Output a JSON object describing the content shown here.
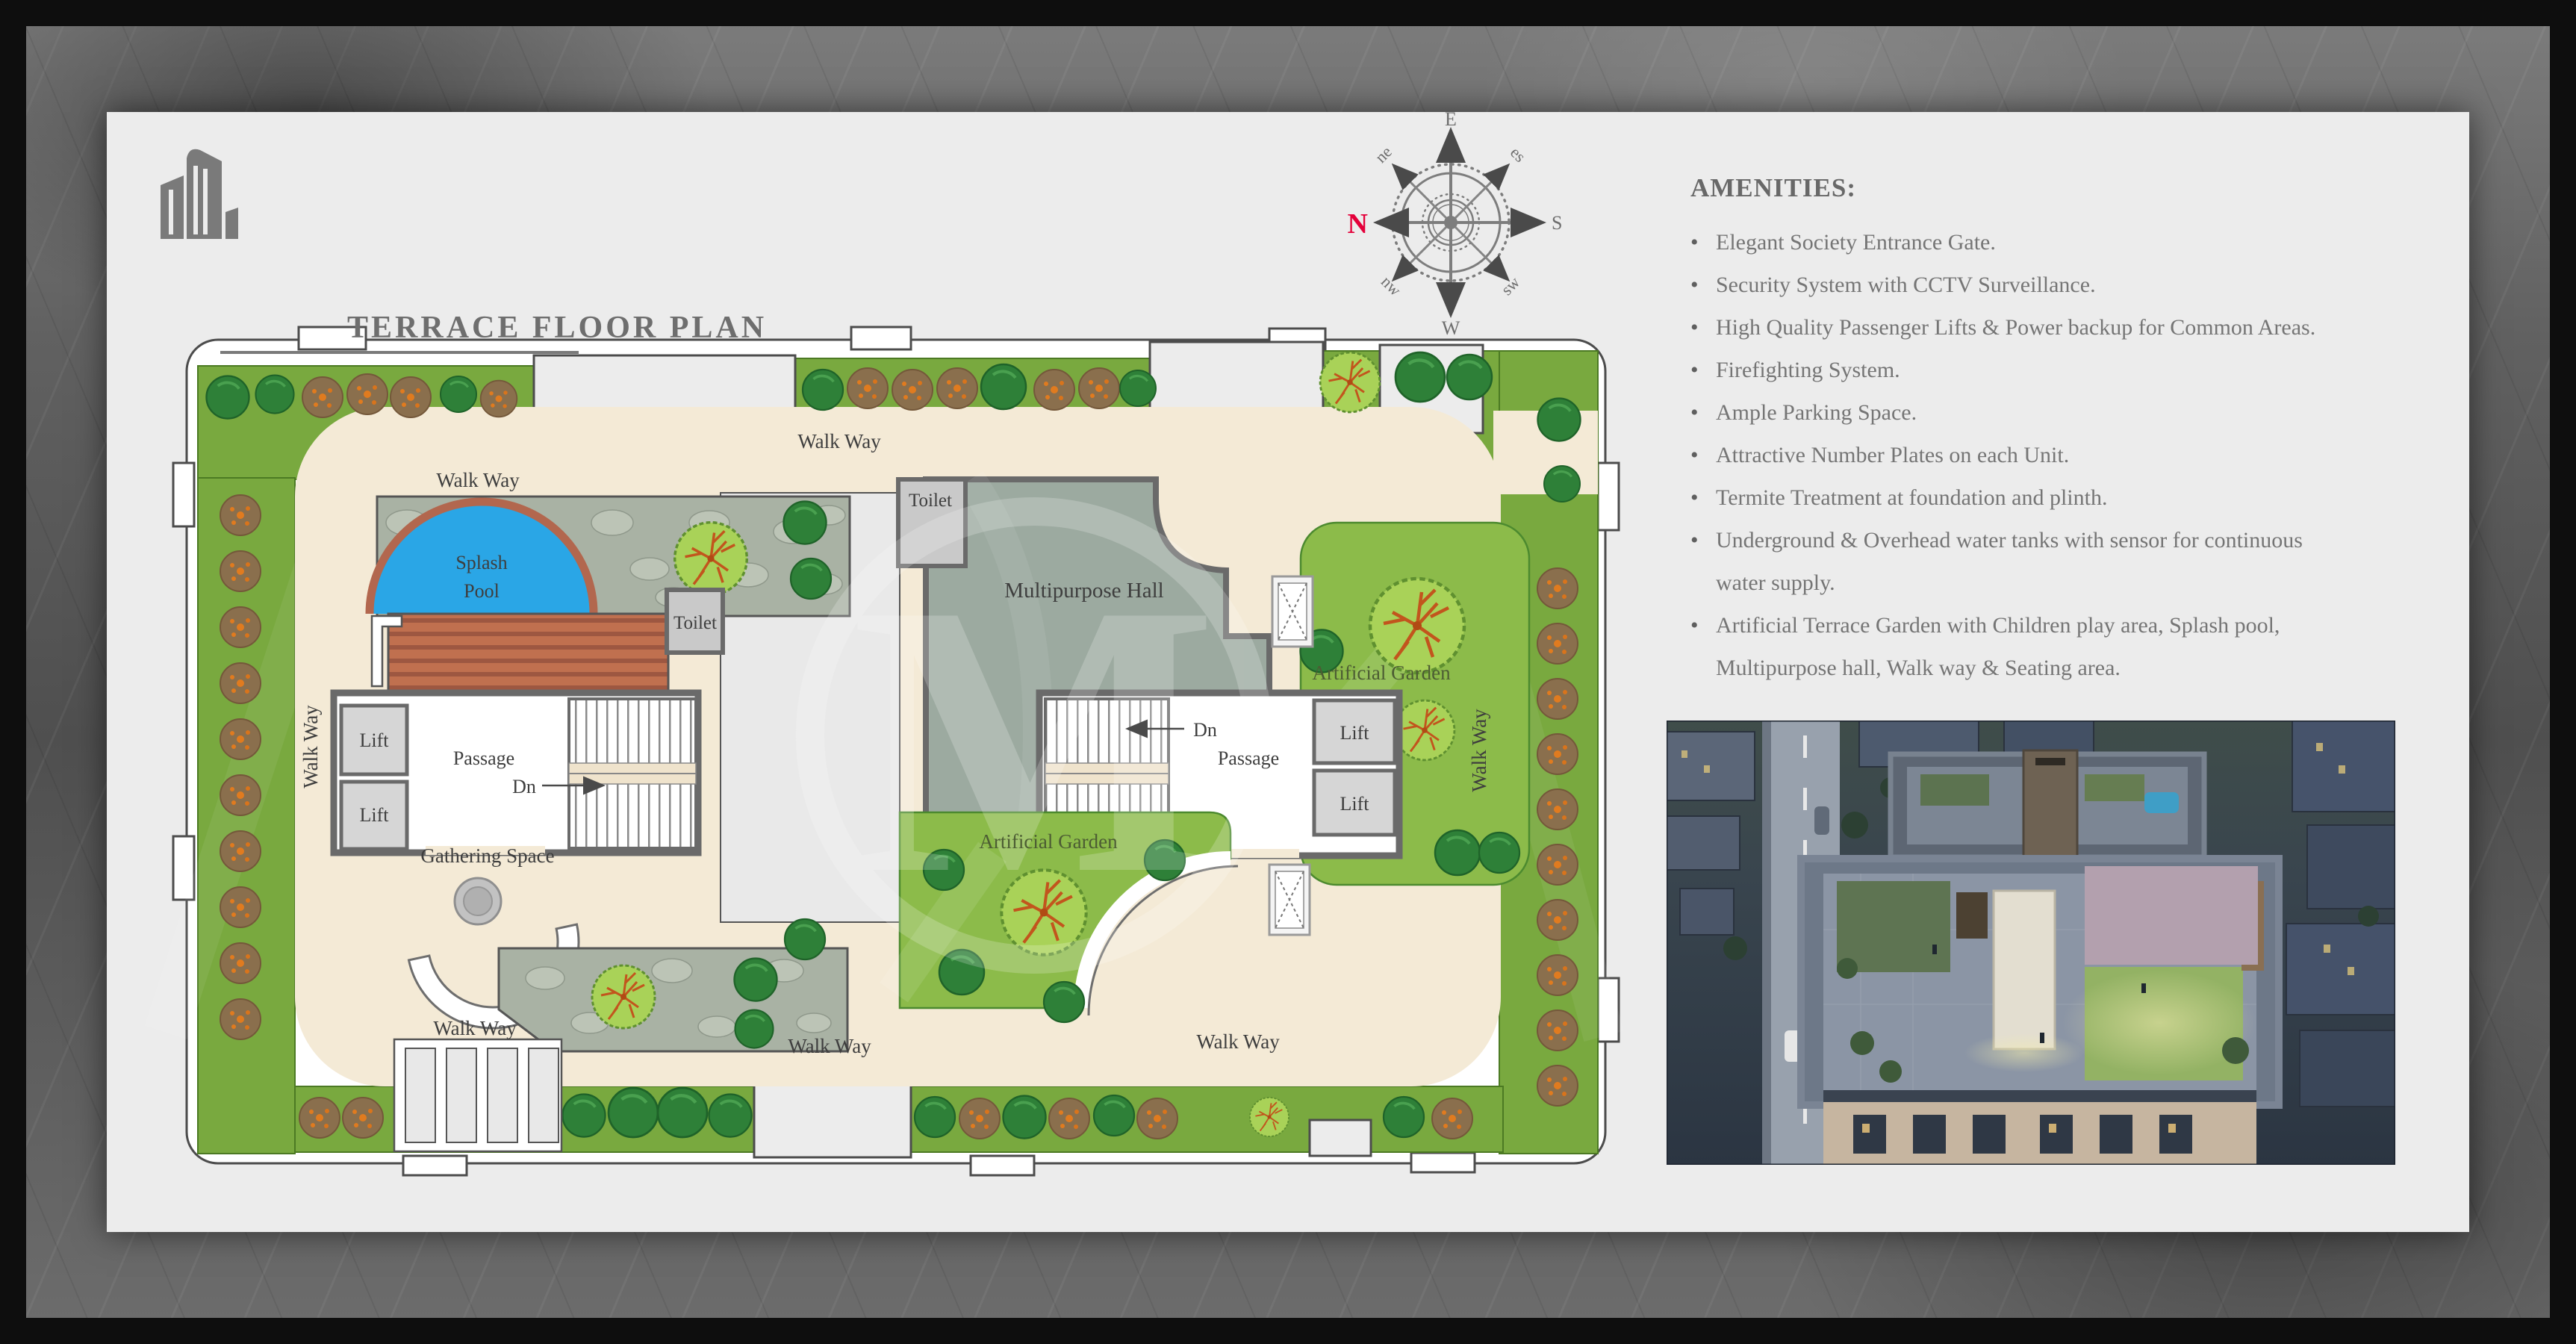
{
  "title": {
    "text": "TERRACE FLOOR PLAN"
  },
  "compass": {
    "n": "N",
    "e": "E",
    "s": "S",
    "w": "W",
    "ne": "ne",
    "es": "es",
    "sw": "sw",
    "nw": "nw",
    "north_color": "#e4003a"
  },
  "amenities": {
    "heading": "AMENITIES:",
    "items": [
      {
        "bullet": "•",
        "text": "Elegant Society Entrance Gate."
      },
      {
        "bullet": "•",
        "text": "Security System with CCTV Surveillance."
      },
      {
        "bullet": "•",
        "text": "High Quality Passenger Lifts & Power backup for Common Areas."
      },
      {
        "bullet": "•",
        "text": "Firefighting System."
      },
      {
        "bullet": "•",
        "text": "Ample Parking Space."
      },
      {
        "bullet": "•",
        "text": "Attractive Number Plates on each Unit."
      },
      {
        "bullet": "•",
        "text": "Termite Treatment at foundation and plinth."
      },
      {
        "bullet": "•",
        "text": "Underground & Overhead water tanks with sensor for continuous"
      },
      {
        "bullet": "",
        "text": "water supply."
      },
      {
        "bullet": "•",
        "text": "Artificial Terrace Garden with Children play area, Splash pool,"
      },
      {
        "bullet": "",
        "text": "Multipurpose hall, Walk way & Seating area."
      }
    ]
  },
  "plan": {
    "labels": {
      "walk_way": "Walk Way",
      "splash_line1": "Splash",
      "splash_line2": "Pool",
      "toilet": "Toilet",
      "multipurpose_hall": "Multipurpose Hall",
      "artificial_garden": "Artificial Garden",
      "lift": "Lift",
      "passage": "Passage",
      "dn": "Dn",
      "gathering_space": "Gathering Space"
    }
  },
  "colors": {
    "page": "#ececec",
    "walkway": "#f4ead6",
    "lawn": "#79a93f",
    "stone": "#a9b2a4",
    "pool": "#2aa6e6",
    "pool_rim": "#b2674e",
    "deck": "#c0704f",
    "hall": "#9caaa0",
    "garden": "#8cbb4a",
    "wall": "#6a6a6a",
    "room": "#c9c9c9",
    "label_text": "#3e3e3e",
    "north": "#e4003a"
  }
}
